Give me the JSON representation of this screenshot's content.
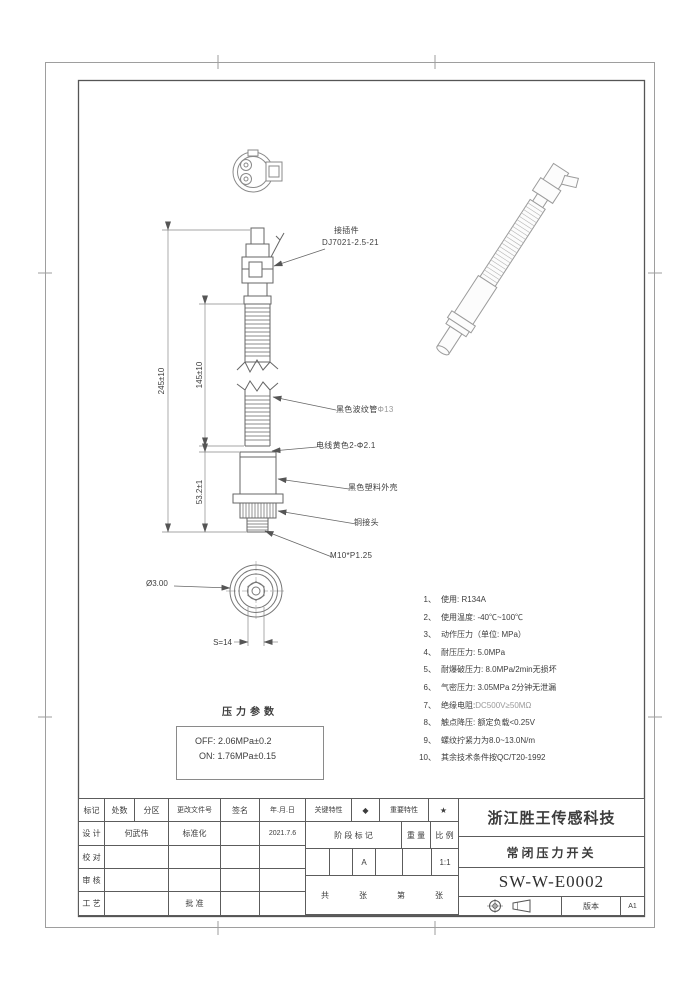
{
  "page": {
    "bg": "#ffffff",
    "line_color": "#6b6b6b",
    "light_line_color": "#a8a8a8",
    "grey_text_color": "#9a9a9a"
  },
  "drawing": {
    "callouts": {
      "connector": {
        "line1": "接插件",
        "line2": "DJ7021-2.5-21"
      },
      "corrugated_tube": {
        "text": "黑色波纹管",
        "grey": "Φ13"
      },
      "wire": "电线黄色2-Φ2.1",
      "plastic_housing": "黑色塑料外壳",
      "copper_joint": "铜接头",
      "thread": "M10*P1.25"
    },
    "dimensions": {
      "overall_length": "245±10",
      "tube_length": "145±10",
      "lower_length": "53.2±1",
      "hole_diameter": "Ø3.00",
      "hex_width": "S=14"
    },
    "pressure_params": {
      "title": "压力参数",
      "off": "OFF: 2.06MPa±0.2",
      "on": "ON: 1.76MPa±0.15"
    },
    "notes": [
      {
        "no": "1、",
        "text": "使用: R134A"
      },
      {
        "no": "2、",
        "text": "使用温度: -40℃~100℃"
      },
      {
        "no": "3、",
        "text": "动作压力（单位: MPa）"
      },
      {
        "no": "4、",
        "text": "耐压压力: 5.0MPa"
      },
      {
        "no": "5、",
        "text": "耐爆破压力: 8.0MPa/2min无损坏"
      },
      {
        "no": "6、",
        "text": "气密压力: 3.05MPa 2分钟无泄漏"
      },
      {
        "no": "7、",
        "text": "绝缘电阻: ",
        "grey": "DC500V≥50MΩ"
      },
      {
        "no": "8、",
        "text": "触点降压: 额定负载<0.25V"
      },
      {
        "no": "9、",
        "text": "螺纹拧紧力为8.0~13.0N/m"
      },
      {
        "no": "10、",
        "text": "其余技术条件按QC/T20-1992"
      }
    ]
  },
  "title_block": {
    "rev_header": {
      "mark": "标记",
      "count": "处数",
      "zone": "分区",
      "doc_no": "更改文件号",
      "sign": "签名",
      "date": "年.月.日"
    },
    "roles": {
      "design": "设 计",
      "check": "校 对",
      "review": "审 核",
      "process": "工 艺",
      "standard": "标准化",
      "approve": "批 准"
    },
    "values": {
      "designer": "何武伟",
      "design_date": "2021.7.6",
      "stage_mark": "A",
      "scale": "1:1",
      "version": "A1"
    },
    "characteristics": {
      "key_label": "关键特性",
      "key_symbol": "◆",
      "important_label": "重要特性",
      "important_symbol": "★"
    },
    "stage": {
      "stage_label": "阶 段 标 记",
      "weight_label": "重 量",
      "scale_label": "比 例"
    },
    "sheet": {
      "total_label": "共",
      "total_unit": "张",
      "page_label": "第",
      "page_unit": "张"
    },
    "product": {
      "company": "浙江胜王传感科技",
      "name": "常闭压力开关",
      "drawing_no": "SW-W-E0002",
      "version_label": "版本"
    }
  }
}
